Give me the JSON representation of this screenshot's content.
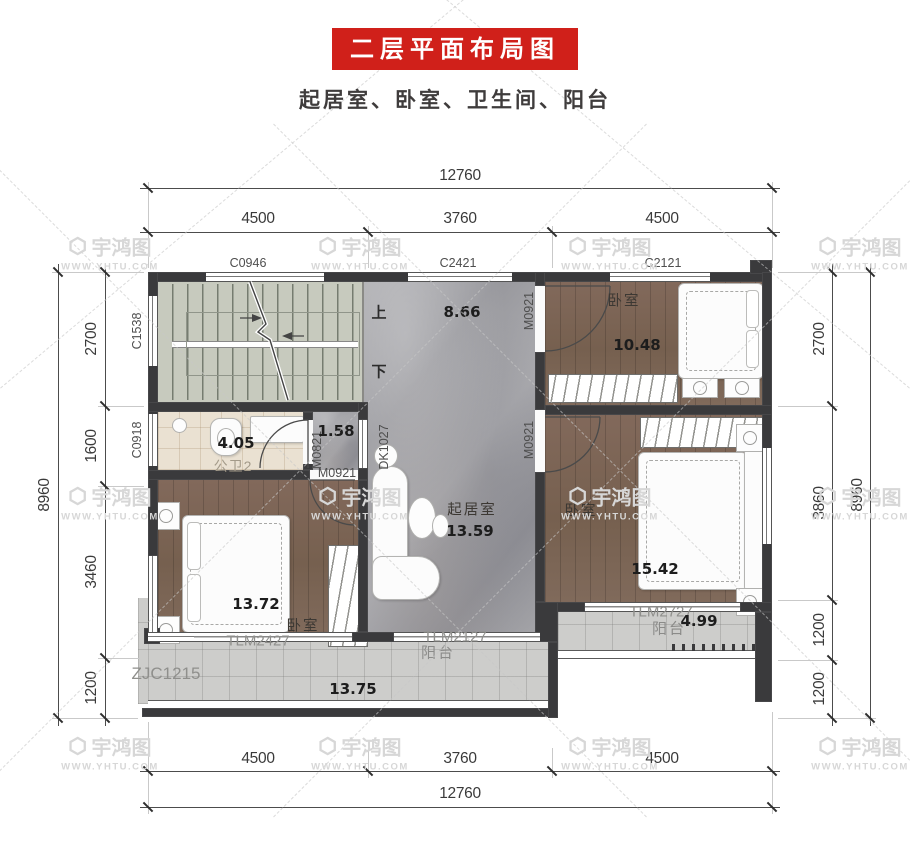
{
  "title": {
    "banner": "二层平面布局图",
    "subtitle": "起居室、卧室、卫生间、阳台"
  },
  "watermark": {
    "brand": "宇鸿图",
    "url": "WWW.YHTU.COM"
  },
  "colors": {
    "accent_red": "#d0201a",
    "wall": "#3a3a3c",
    "marble": "#a1a1a5",
    "wood": "#7d675a",
    "tile": "#cdcdcb",
    "bath_tile": "#eae1d2",
    "stair": "#c7cabe"
  },
  "dimensions": {
    "top": {
      "overall": "12760",
      "segments": [
        "4500",
        "3760",
        "4500"
      ]
    },
    "bottom": {
      "overall": "12760",
      "segments": [
        "4500",
        "3760",
        "4500"
      ]
    },
    "left": {
      "overall": "8960",
      "segments": [
        "2700",
        "1600",
        "3460",
        "1200"
      ]
    },
    "right": {
      "overall": "8960",
      "segments": [
        "2700",
        "3860",
        "1200",
        "1200"
      ]
    }
  },
  "codes": {
    "c0946": "C0946",
    "c2421": "C2421",
    "c2121": "C2121",
    "c1538": "C1538",
    "c0918": "C0918",
    "zjc1215": "ZJC1215",
    "m0921": "M0921",
    "m0821": "M0821",
    "dk1027": "DK1027",
    "tlm2127": "TLM2127",
    "tlm2427": "TLM2427",
    "tlm2727": "TLM2727"
  },
  "stairs": {
    "up": "上",
    "down": "下"
  },
  "rooms": {
    "corridor": {
      "area": "8.66"
    },
    "living": {
      "name": "起居室",
      "area": "13.59"
    },
    "nook": {
      "area": "1.58"
    },
    "bath": {
      "name": "公卫2",
      "area": "4.05"
    },
    "bedroom_top": {
      "name": "卧室",
      "area": "10.48"
    },
    "bedroom_left": {
      "name": "卧室",
      "area": "13.72"
    },
    "bedroom_right": {
      "name": "卧室",
      "area": "15.42"
    },
    "balcony_main": {
      "name": "阳台",
      "area": "13.75"
    },
    "balcony_right": {
      "name": "阳台",
      "area": "4.99"
    }
  }
}
